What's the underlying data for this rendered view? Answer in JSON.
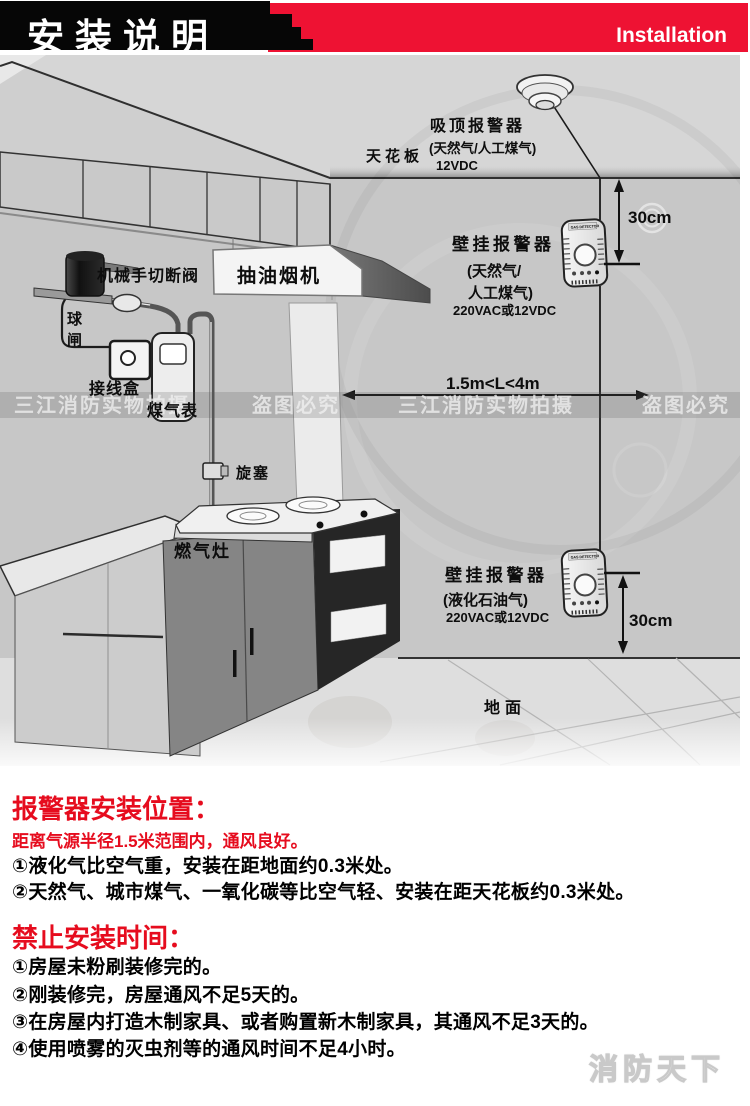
{
  "banner": {
    "title_cn": "安装说明",
    "title_en": "Installation"
  },
  "diagram": {
    "ceiling_label": "天花板",
    "ground_label": "地面",
    "range_label": "1.5m<L<4m",
    "ceiling_alarm": {
      "title": "吸顶报警器",
      "subtitle": "(天然气/人工煤气)",
      "power": "12VDC"
    },
    "wall_alarm_top": {
      "title": "壁挂报警器",
      "subtitle1": "(天然气/",
      "subtitle2": "人工煤气)",
      "power": "220VAC或12VDC",
      "distance": "30cm"
    },
    "wall_alarm_bottom": {
      "title": "壁挂报警器",
      "subtitle": "(液化石油气)",
      "power": "220VAC或12VDC",
      "distance": "30cm"
    },
    "cutoff_valve_label": "机械手切断阀",
    "hood_label": "抽油烟机",
    "ball_valve_char1": "球",
    "ball_valve_char2": "闸",
    "junction_box_label": "接线盒",
    "gas_meter_label": "煤气表",
    "plug_valve_label": "旋塞",
    "stove_label": "燃气灶",
    "detector_brand": "GAS DETECTOR",
    "watermark_studio": "三江消防实物拍摄",
    "watermark_warning": "盗图必究"
  },
  "sections": [
    {
      "heading": "报警器安装位置：",
      "sub": "距离气源半径1.5米范围内，通风良好。",
      "items": [
        "①液化气比空气重，安装在距地面约0.3米处。",
        "②天然气、城市煤气、一氧化碳等比空气轻、安装在距天花板约0.3米处。"
      ]
    },
    {
      "heading": "禁止安装时间：",
      "items": [
        "①房屋未粉刷装修完的。",
        "②刚装修完，房屋通风不足5天的。",
        "③在房屋内打造木制家具、或者购置新木制家具，其通风不足3天的。",
        "④使用喷雾的灭虫剂等的通风时间不足4小时。"
      ]
    }
  ],
  "footer_watermark": "消防天下",
  "colors": {
    "banner_red": "#ee1233",
    "heading_red": "#e60c1e",
    "text_black": "#000000"
  }
}
